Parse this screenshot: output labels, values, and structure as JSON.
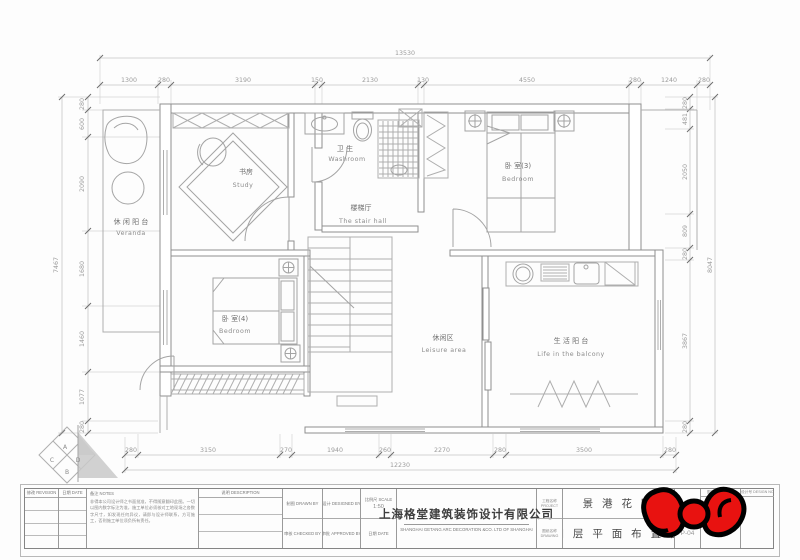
{
  "drawing": {
    "rooms": {
      "veranda": {
        "cn": "休 闲 阳 台",
        "en": "Veranda"
      },
      "study": {
        "cn": "书房",
        "en": "Study"
      },
      "washroom": {
        "cn": "卫 生",
        "en": "Washroom"
      },
      "stair_hall": {
        "cn": "楼梯厅",
        "en": "The stair hall"
      },
      "bedroom3": {
        "cn": "卧 室(3)",
        "en": "Bedroom"
      },
      "bedroom4": {
        "cn": "卧 室(4)",
        "en": "Bedroom"
      },
      "leisure": {
        "cn": "休闲区",
        "en": "Leisure area"
      },
      "balcony": {
        "cn": "生 活 阳 台",
        "en": "Life in the balcony"
      }
    },
    "dims": {
      "top_total": "13530",
      "top": [
        "1300",
        "280",
        "3190",
        "150",
        "2130",
        "130",
        "4550",
        "280",
        "1240",
        "280"
      ],
      "left_total": "7467",
      "left": [
        "280",
        "600",
        "2090",
        "1680",
        "1460",
        "1077",
        "280"
      ],
      "right_total": "8047",
      "right": [
        "280",
        "481",
        "2050",
        "809",
        "280",
        "3867",
        "280"
      ],
      "bottom_total": "12230",
      "bottom": [
        "280",
        "3150",
        "270",
        "1940",
        "260",
        "2270",
        "280",
        "3500",
        "280"
      ]
    },
    "compass": {
      "a": "A",
      "b": "B",
      "c": "C",
      "d": "D"
    }
  },
  "titleblock": {
    "revision_label": "修改 REVISION",
    "date_label": "日期 DATE",
    "notes_label": "备注 NOTES",
    "notes_text": "非得本公司设计师之书面批准，不得随意翻印此图。一切以图内数字标注为准，施工单位必须核对工地现场之各数字尺寸，如发现任何异议，请即与设计师联系，方可施工，否则施工单位须负所有责任。",
    "description_label": "说明 DESCRIPTION",
    "drawn_label": "制图 DRAWN BY",
    "checked_label": "审核 CHECKED BY",
    "designed_label": "设计 DESIGNED BY",
    "approved_label": "审批 APPROVED BY",
    "scale_label": "比例尺 SCALE",
    "scale_value": "1:50",
    "date2_label": "日期 DATE",
    "company_cn": "上海格堂建筑装饰设计有限公司",
    "company_en": "SHANGHAI GETANG ARC DECORATION  &CO. LTD OF SHANGHAI",
    "project_label_cn": "工程名称",
    "project_label_en": "PROJECT",
    "drawing_label_cn": "图纸名称",
    "drawing_label_en": "DRAWING",
    "project_name": "景 港 花 园",
    "drawing_name": "四 层 平 面 布 置 图",
    "drawing_no": "P-04",
    "sheet_label_cn": "图号",
    "sheet_label_en": "SHEET NO",
    "sheet_no": "95",
    "design_label_cn": "设计号",
    "design_label_en": "DESIGN NO"
  }
}
